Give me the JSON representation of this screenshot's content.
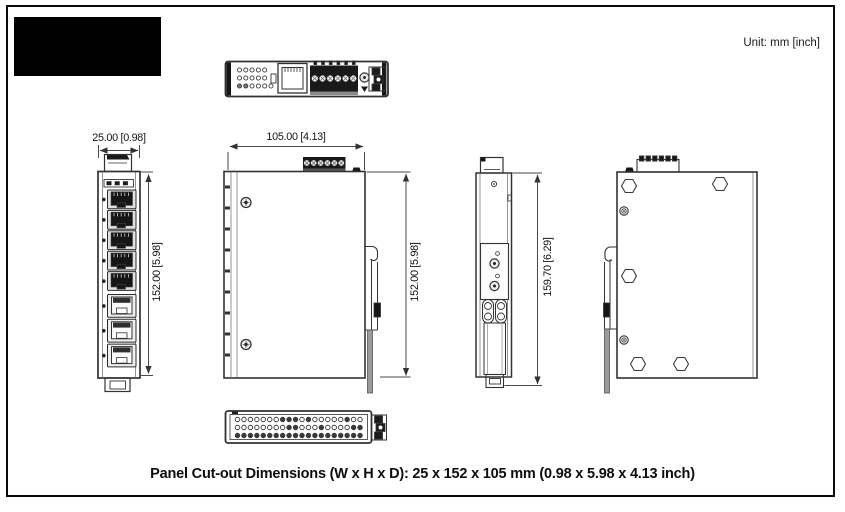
{
  "page": {
    "unit_label": "Unit: mm [inch]",
    "caption": "Panel Cut-out Dimensions (W x H x D): 25 x 152 x 105 mm (0.98 x 5.98 x 4.13 inch)"
  },
  "dimensions": {
    "front_width": "25.00 [0.98]",
    "front_height": "152.00 [5.98]",
    "side_depth": "105.00 [4.13]",
    "side_height": "152.00 [5.98]",
    "rear_side_height": "159.70 [6.29]"
  },
  "colors": {
    "line": "#3a3a3a",
    "dark_fill": "#161616",
    "dim_line": "#4a4a4a",
    "text": "#111111",
    "logo_block": "#000000"
  }
}
